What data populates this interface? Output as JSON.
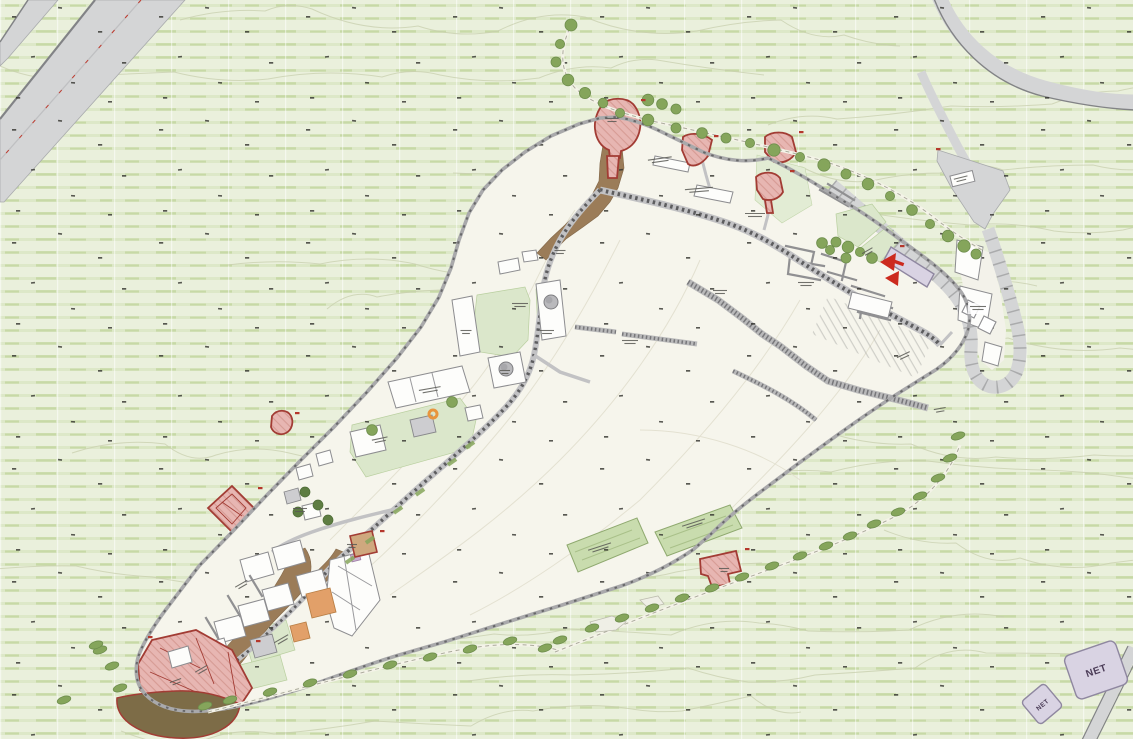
{
  "title": "Hilltop fortress archaeological site master plan",
  "map": {
    "kind": "site-plan",
    "orientation": "wedge-shaped walled plateau, tip at southwest, visitor entrance at east",
    "colors": {
      "bg": "#eaf0dc",
      "stripe": "#d8e5c0",
      "site": "#f6f5ec",
      "road": "#d4d5d6",
      "road-edge": "#828386",
      "wall": "#a9a9ab",
      "wall-dash": "#68686a",
      "path": "#c2c2c4",
      "path-dash": "#5d5d5f",
      "lawn": "#dbe7cb",
      "garden": "#c9dcae",
      "tree": "#85a55b",
      "bush": "#86a65c",
      "trail": "#9b7c58",
      "bastion-ground": "#7d6c47",
      "bldg": "#fdfdfb",
      "bldg-stroke": "#8d8d90",
      "bldg-gray": "#cdcdd0",
      "bldg-orange": "#e2a069",
      "monument": "#e7b6b2",
      "monument-stroke": "#a23c34",
      "strip": "#3cb53c",
      "arrow": "#cc2a1e",
      "net": "#d9d3e3",
      "net-stroke": "#8f87a0",
      "net-text": "#4b3c57",
      "contour": "#c8cfae",
      "contour-inner": "#e3e0d0",
      "spot": "#31312c",
      "grid": "#ffffff"
    },
    "features": [
      {
        "id": "highway-northwest",
        "type": "road"
      },
      {
        "id": "upper-road-northeast",
        "type": "road"
      },
      {
        "id": "parking-overlook",
        "type": "road-area"
      },
      {
        "id": "hairpin-entrance-drive",
        "type": "road"
      },
      {
        "id": "road-southeast-corner",
        "type": "road"
      },
      {
        "id": "walled-plateau",
        "type": "site-boundary"
      },
      {
        "id": "northwest-gate-tower",
        "type": "monument-red"
      },
      {
        "id": "north-wall-tower-a",
        "type": "monument-red"
      },
      {
        "id": "north-wall-tower-b",
        "type": "monument-red"
      },
      {
        "id": "north-inner-tower",
        "type": "monument-red"
      },
      {
        "id": "west-wall-turret",
        "type": "monument-red"
      },
      {
        "id": "west-wall-diamond-tower",
        "type": "monument-red"
      },
      {
        "id": "inner-keep-block",
        "type": "monument-red"
      },
      {
        "id": "south-wall-tower",
        "type": "monument-red"
      },
      {
        "id": "southwest-bastion",
        "type": "monument-red"
      },
      {
        "id": "bastion-glacis",
        "type": "earthwork"
      },
      {
        "id": "entrance-ramp-strip",
        "type": "entrance-marker"
      },
      {
        "id": "entrance-direction-arrows",
        "type": "entrance-marker"
      },
      {
        "id": "tree-lined-north-trail",
        "type": "trail"
      },
      {
        "id": "south-slope-trail",
        "type": "trail"
      },
      {
        "id": "garden-plot-west",
        "type": "garden"
      },
      {
        "id": "garden-plot-east",
        "type": "garden"
      },
      {
        "id": "upper-building-cluster",
        "type": "buildings"
      },
      {
        "id": "mid-building-cluster",
        "type": "buildings"
      },
      {
        "id": "lower-town-cluster",
        "type": "buildings"
      },
      {
        "id": "hairpin-loop-buildings",
        "type": "buildings"
      },
      {
        "id": "ruined-long-wall",
        "type": "ruin"
      },
      {
        "id": "palace-ruin-maze",
        "type": "ruin"
      },
      {
        "id": "net-building-large",
        "type": "building-labeled"
      },
      {
        "id": "net-building-small",
        "type": "building-labeled"
      }
    ]
  },
  "labels": {
    "net_large": "NET",
    "net_small": "NET"
  }
}
